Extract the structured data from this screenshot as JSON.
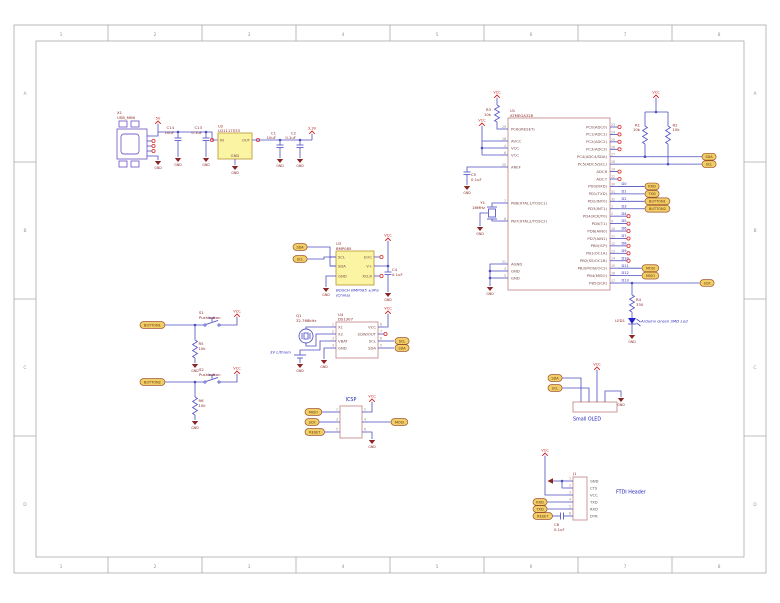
{
  "sheet": {
    "frame_columns": [
      "1",
      "2",
      "3",
      "4",
      "5",
      "6",
      "7",
      "8"
    ],
    "frame_rows": [
      "A",
      "B",
      "C",
      "D"
    ]
  },
  "colors": {
    "wire": "#4d4dc0",
    "box_outline": "#c98d8d",
    "ic_fill": "#fbf5a3",
    "flag_fill": "#efcf66",
    "gnd": "#8b2525",
    "vcc": "#cc2020",
    "annotation": "#2222bb"
  },
  "power_labels": {
    "v5": "5V",
    "v33": "3.3V",
    "vcc": "VCC",
    "gnd": "GND"
  },
  "usb": {
    "refdes": "X1",
    "value": "USB_MINI"
  },
  "input_caps": [
    {
      "refdes": "C14",
      "value": "10uF"
    },
    {
      "refdes": "C13",
      "value": "0.1uF"
    }
  ],
  "regulator": {
    "refdes": "U2",
    "value": "LD1117S33",
    "pins": {
      "in": "IN",
      "out": "OUT",
      "gnd": "GND"
    }
  },
  "output_caps": [
    {
      "refdes": "C1",
      "value": "10uF"
    },
    {
      "refdes": "C2",
      "value": "0.1uF"
    }
  ],
  "reset_pullup": {
    "refdes": "R3",
    "value": "10k"
  },
  "i2c_pullups": [
    {
      "refdes": "R1",
      "value": "10k"
    },
    {
      "refdes": "R2",
      "value": "10k"
    }
  ],
  "aref_cap": {
    "refdes": "C5",
    "value": "0.1uF"
  },
  "crystal": {
    "refdes": "Y1",
    "value": "16MHz"
  },
  "led": {
    "refdes": "LED1",
    "note": "Arduino Green SMD Led",
    "resistor": {
      "refdes": "R4",
      "value": "330"
    }
  },
  "mcu": {
    "refdes": "U1",
    "value": "ATMEGA328",
    "left_pins": [
      {
        "name": "PC6(/RESET)",
        "num": "29"
      },
      {
        "name": "AVCC",
        "num": "18"
      },
      {
        "name": "VCC",
        "num": "4"
      },
      {
        "name": "VCC",
        "num": "6"
      },
      {
        "name": "AREF",
        "num": "20"
      },
      {
        "name": "PB6(XTAL1/TOSC1)",
        "num": "7"
      },
      {
        "name": "PB7(XTAL2/TOSC2)",
        "num": "8"
      },
      {
        "name": "AGND",
        "num": "21"
      },
      {
        "name": "GND",
        "num": "3"
      },
      {
        "name": "GND",
        "num": "5"
      }
    ],
    "right_pins": [
      {
        "name": "PC0(ADC0)",
        "num": "23",
        "net": "",
        "flag": ""
      },
      {
        "name": "PC1(ADC1)",
        "num": "24",
        "net": "",
        "flag": ""
      },
      {
        "name": "PC2(ADC2)",
        "num": "25",
        "net": "",
        "flag": ""
      },
      {
        "name": "PC3(ADC3)",
        "num": "26",
        "net": "",
        "flag": ""
      },
      {
        "name": "PC4(ADC4/SDA)",
        "num": "27",
        "net": "",
        "flag": "SDA"
      },
      {
        "name": "PC5(ADC5/SCL)",
        "num": "28",
        "net": "",
        "flag": "SCL"
      },
      {
        "name": "ADC6",
        "num": "19",
        "net": "",
        "flag": ""
      },
      {
        "name": "ADC7",
        "num": "22",
        "net": "",
        "flag": ""
      },
      {
        "name": "PD0(RXD)",
        "num": "30",
        "net": "D0",
        "flag": "RXD"
      },
      {
        "name": "PD1(TXD)",
        "num": "31",
        "net": "D1",
        "flag": "TXD"
      },
      {
        "name": "PD2(INT0)",
        "num": "32",
        "net": "D2",
        "flag": "BUTTON1"
      },
      {
        "name": "PD3(INT1)",
        "num": "1",
        "net": "D3",
        "flag": "BUTTON2"
      },
      {
        "name": "PD4(XCK/T0)",
        "num": "2",
        "net": "D4",
        "flag": ""
      },
      {
        "name": "PD5(T1)",
        "num": "9",
        "net": "D5",
        "flag": ""
      },
      {
        "name": "PD6(AIN0)",
        "num": "10",
        "net": "D6",
        "flag": ""
      },
      {
        "name": "PD7(AIN1)",
        "num": "11",
        "net": "D7",
        "flag": ""
      },
      {
        "name": "PB0(ICP)",
        "num": "12",
        "net": "D8",
        "flag": ""
      },
      {
        "name": "PB1(OC1A)",
        "num": "13",
        "net": "D9",
        "flag": ""
      },
      {
        "name": "PB2(SS/OC1B)",
        "num": "14",
        "net": "D10",
        "flag": ""
      },
      {
        "name": "PB3(MOSI/OC2)",
        "num": "15",
        "net": "D11",
        "flag": "MOSI"
      },
      {
        "name": "PB4(MISO)",
        "num": "16",
        "net": "D12",
        "flag": "MISO"
      },
      {
        "name": "PB5(SCK)",
        "num": "17",
        "net": "D13",
        "flag": "SCK"
      }
    ]
  },
  "bmp": {
    "refdes": "U3",
    "value": "BMP085",
    "flags": [
      "SDA",
      "SCL"
    ],
    "left_pins": [
      "SCL",
      "SDA",
      "GND"
    ],
    "right_pins": [
      "EOC",
      "V+",
      "XCLR"
    ],
    "cap": {
      "refdes": "C4",
      "value": "0.1uF"
    },
    "note1": "BOSCH BMP085 ±9Pa",
    "note2": "(China)"
  },
  "rtc": {
    "refdes": "U4",
    "value": "DS1307",
    "left_pins": [
      {
        "name": "X1",
        "num": "1"
      },
      {
        "name": "X2",
        "num": "2"
      },
      {
        "name": "VBAT",
        "num": "3"
      },
      {
        "name": "GND",
        "num": "4"
      }
    ],
    "right_pins": [
      {
        "name": "VCC",
        "num": "8"
      },
      {
        "name": "SQW/OUT",
        "num": "7"
      },
      {
        "name": "SCL",
        "num": "6"
      },
      {
        "name": "SDA",
        "num": "5"
      }
    ],
    "flags": [
      "SCL",
      "SDA"
    ],
    "crystal": {
      "refdes": "Q1",
      "value": "32.768kHz"
    },
    "battery_note": "3V Lithium"
  },
  "buttons": [
    {
      "flag": "BUTTON1",
      "switch_refdes": "S1",
      "switch_value": "Pushbutton",
      "res_refdes": "R5",
      "res_value": "10k"
    },
    {
      "flag": "BUTTON2",
      "switch_refdes": "S2",
      "switch_value": "Pushbutton",
      "res_refdes": "R6",
      "res_value": "10k"
    }
  ],
  "icsp": {
    "title": "ICSP",
    "flags_left": [
      "MISO",
      "SCK",
      "RESET"
    ],
    "flag_right": "MOSI",
    "pin_numbers_left": [
      "1",
      "3",
      "5"
    ],
    "pin_numbers_right": [
      "2",
      "4",
      "6"
    ]
  },
  "oled": {
    "title": "Small OLED",
    "flags": [
      "SDA",
      "SCL"
    ]
  },
  "ftdi": {
    "refdes": "J1",
    "title": "FTDI Header",
    "pin_labels": [
      "GND",
      "CTS",
      "VCC",
      "TXD",
      "RXD",
      "DTR"
    ],
    "pin_numbers": [
      "1",
      "2",
      "3",
      "4",
      "5",
      "6"
    ],
    "flags": [
      "RXD",
      "TXD",
      "RESET"
    ],
    "cap": {
      "refdes": "C8",
      "value": "0.1uF"
    }
  }
}
